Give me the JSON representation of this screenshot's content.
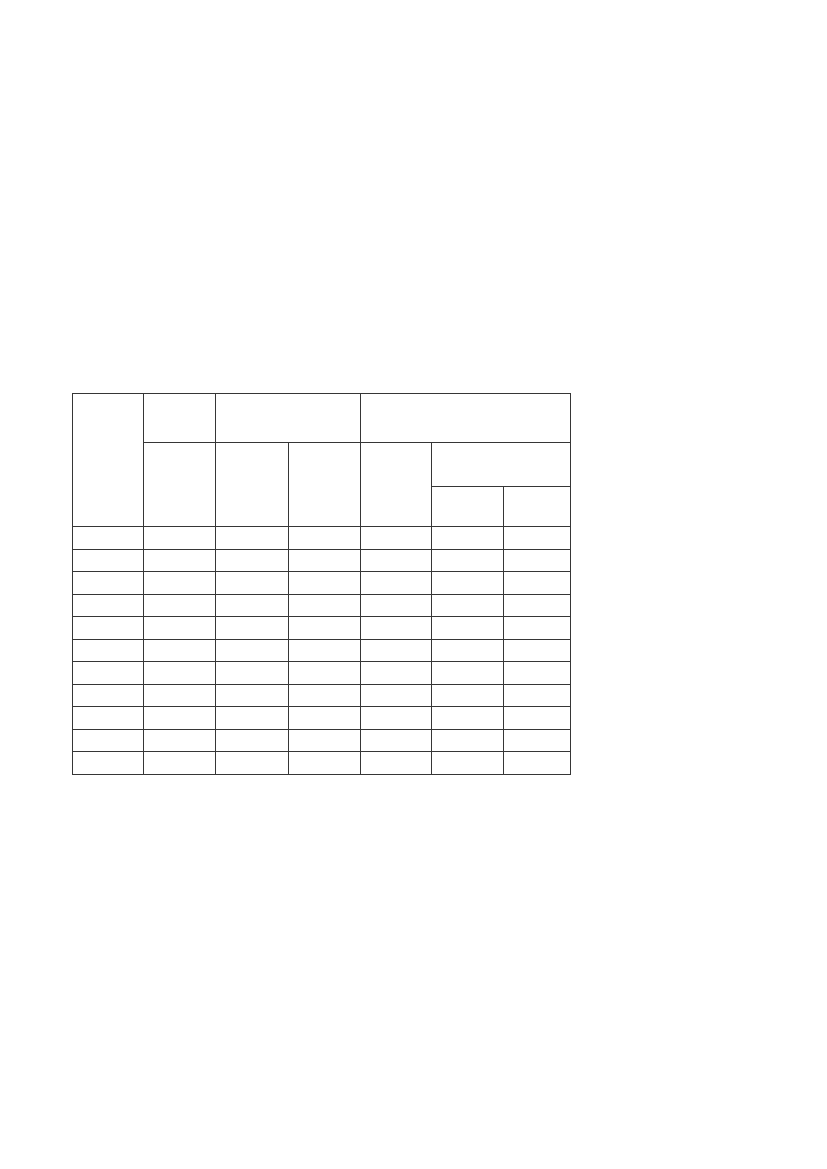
{
  "page": {
    "background_color": "#ffffff"
  },
  "table": {
    "border_color": "#363636",
    "column_count": 7,
    "column_widths_px": [
      71,
      72,
      73,
      72,
      71,
      72,
      67
    ],
    "position": {
      "left_px": 72,
      "top_px": 393,
      "width_px": 498,
      "height_px": 381
    },
    "header": {
      "row1": {
        "col1": "",
        "col2_top": "",
        "col3_4_group": "",
        "col5_6_7_group": ""
      },
      "row2": {
        "col2": "",
        "col3": "",
        "col4": "",
        "col5": "",
        "col6_7_group": ""
      },
      "row3": {
        "col6": "",
        "col7": ""
      }
    },
    "body": {
      "row_count": 11,
      "rows": [
        [
          "",
          "",
          "",
          "",
          "",
          "",
          ""
        ],
        [
          "",
          "",
          "",
          "",
          "",
          "",
          ""
        ],
        [
          "",
          "",
          "",
          "",
          "",
          "",
          ""
        ],
        [
          "",
          "",
          "",
          "",
          "",
          "",
          ""
        ],
        [
          "",
          "",
          "",
          "",
          "",
          "",
          ""
        ],
        [
          "",
          "",
          "",
          "",
          "",
          "",
          ""
        ],
        [
          "",
          "",
          "",
          "",
          "",
          "",
          ""
        ],
        [
          "",
          "",
          "",
          "",
          "",
          "",
          ""
        ],
        [
          "",
          "",
          "",
          "",
          "",
          "",
          ""
        ],
        [
          "",
          "",
          "",
          "",
          "",
          "",
          ""
        ],
        [
          "",
          "",
          "",
          "",
          "",
          "",
          ""
        ]
      ]
    }
  }
}
